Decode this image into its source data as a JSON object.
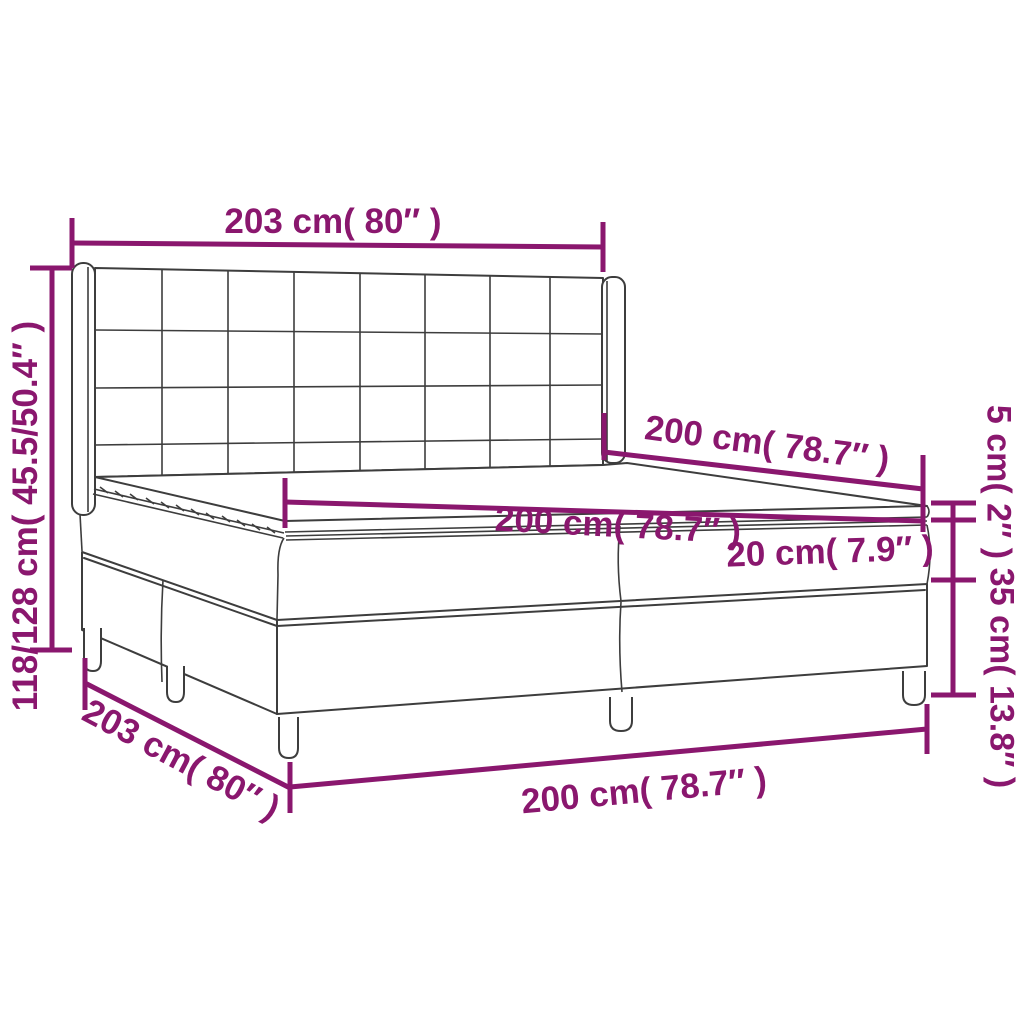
{
  "colors": {
    "dimension_purple": "#8A176E",
    "outline_gray": "#3D3D3D",
    "background": "#FFFFFF"
  },
  "labels": {
    "headboard_width": "203 cm( 80″ )",
    "overall_height": "118/128 cm( 45.5/50.4″ )",
    "mattress_length": "200 cm( 78.7″ )",
    "mattress_width": "200 cm( 78.7″ )",
    "mattress_thickness": "20 cm( 7.9″ )",
    "topper_thickness": "5 cm( 2″ )",
    "base_height": "35 cm( 13.8″ )",
    "base_length": "203 cm( 80″ )",
    "base_width": "200 cm( 78.7″ )"
  }
}
